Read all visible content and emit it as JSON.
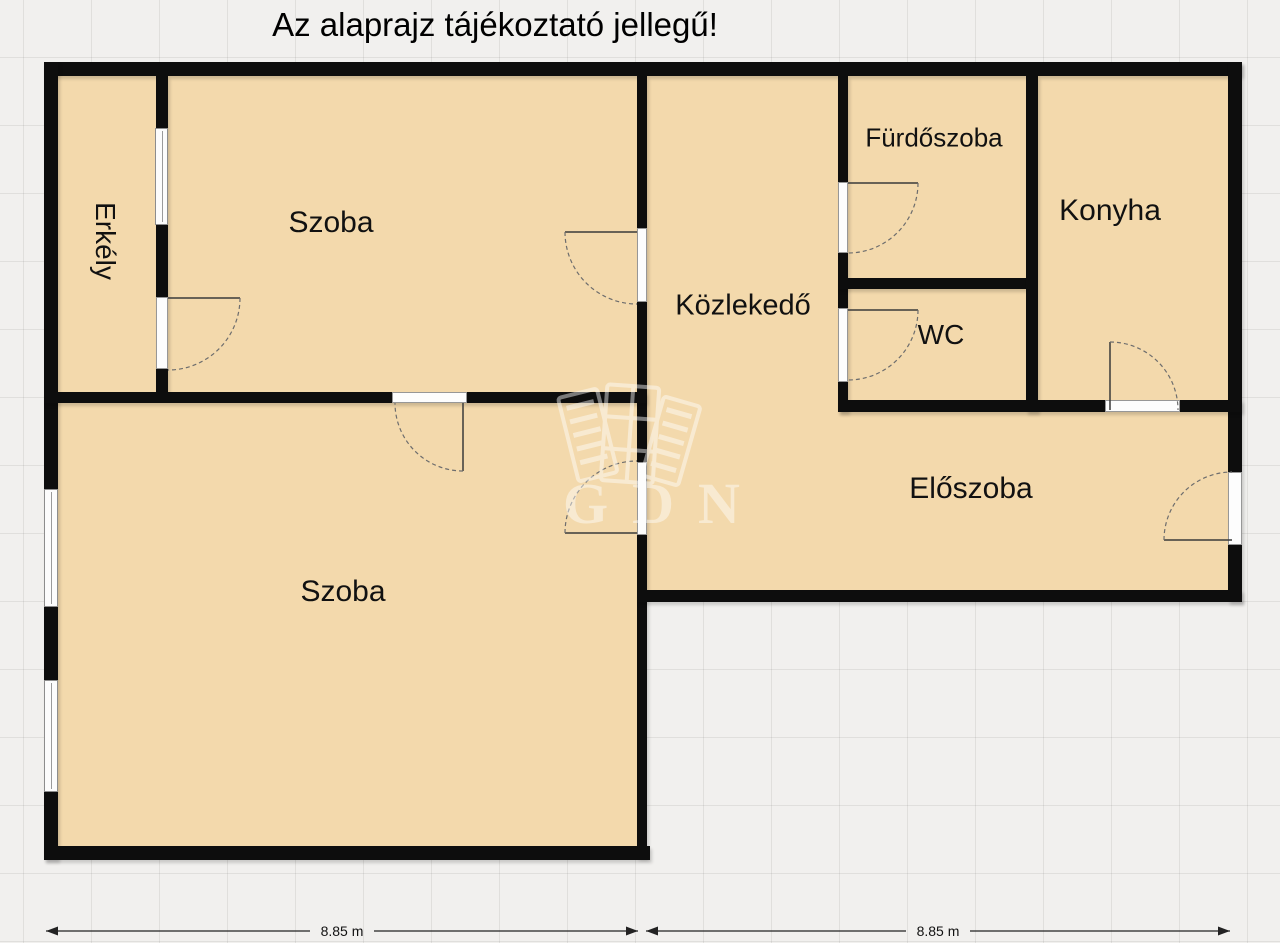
{
  "title": "Az alaprajz tájékoztató jellegű!",
  "rooms": {
    "erkely": {
      "label": "Erkély"
    },
    "szoba_top": {
      "label": "Szoba"
    },
    "szoba_bottom": {
      "label": "Szoba"
    },
    "kozlekedo": {
      "label": "Közlekedő"
    },
    "furdoszoba": {
      "label": "Fürdőszoba"
    },
    "wc": {
      "label": "WC"
    },
    "konyha": {
      "label": "Konyha"
    },
    "eloszoba": {
      "label": "Előszoba"
    }
  },
  "dimensions": {
    "left": {
      "label": "8.85 m"
    },
    "right": {
      "label": "8.85 m"
    }
  },
  "watermark": {
    "text": "GDN"
  },
  "colors": {
    "room_fill": "#f3d9ac",
    "wall": "#0d0d0d",
    "background": "#f1f0ee"
  }
}
